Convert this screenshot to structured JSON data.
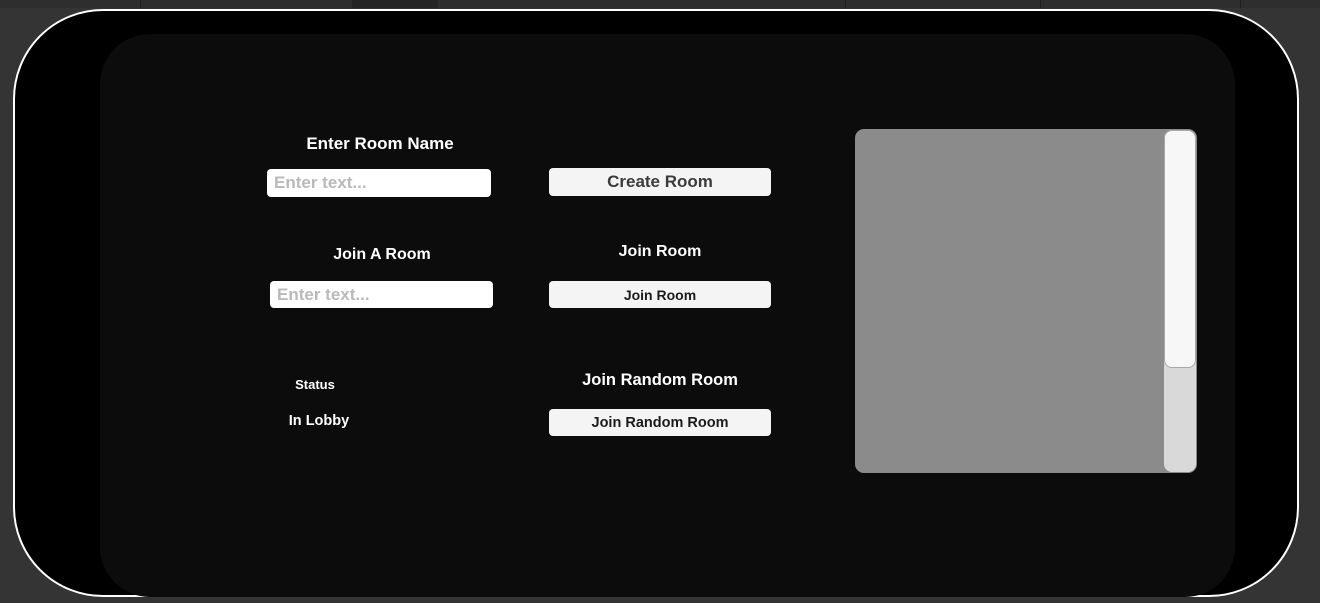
{
  "colors": {
    "editor_background": "#343434",
    "tab_strip": "#2e2e2e",
    "view_background": "#000000",
    "view_border": "#ffffff",
    "inner_panel": "#0c0c0c",
    "button_background": "#f4f4f4",
    "button_text": "#333333",
    "input_background": "#ffffff",
    "placeholder_text": "#b9b9b9",
    "label_text": "#ffffff",
    "room_list_background": "#8b8b8b",
    "scrollbar_thumb": "#f7f7f7",
    "scrollbar_track": "#d9d9d9"
  },
  "create_room": {
    "label": "Enter Room Name",
    "input_placeholder": "Enter text...",
    "input_value": "",
    "button_label": "Create Room"
  },
  "join_room": {
    "label": "Join A Room",
    "input_placeholder": "Enter text...",
    "input_value": "",
    "header": "Join Room",
    "button_label": "Join Room"
  },
  "join_random": {
    "header": "Join Random Room",
    "button_label": "Join Random Room"
  },
  "status": {
    "label": "Status",
    "value": "In Lobby"
  },
  "room_list": {
    "items": []
  }
}
